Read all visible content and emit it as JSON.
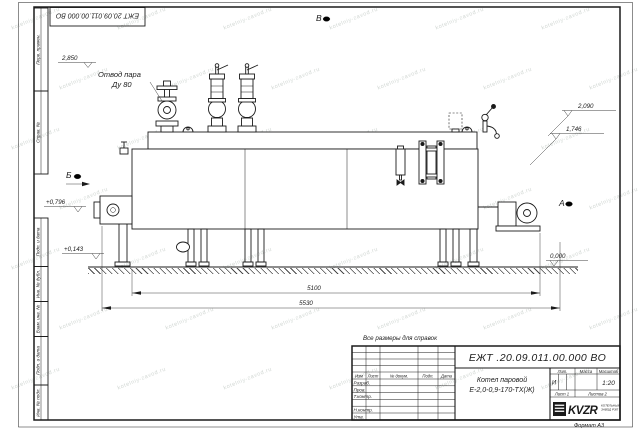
{
  "sheet": {
    "watermark": "kotelniy-zavod.ru",
    "format": "Формат А3"
  },
  "doc": {
    "number": "ЕЖТ .20.09.011.00.000  ВО",
    "number_corner": "ЕЖТ 20.09.011.00.000  ВО",
    "product_line1": "Котел паровой",
    "product_line2": "Е-2,0-0,9-170-ТХ(Ж)",
    "lit": "И",
    "scale": "1:20",
    "sheet_no": "Лист 1",
    "sheets_total": "Листов 2"
  },
  "title_block": {
    "col_izm": "Изм",
    "col_list": "Лист",
    "col_doc": "№ докум.",
    "col_sign": "Подп.",
    "col_date": "Дата",
    "row_razrab": "Разраб.",
    "row_prov": "Пров.",
    "row_tcontr": "Т.контр.",
    "row_ncontr": "Н.контр.",
    "row_utv": "Утв.",
    "hdr_lit": "Лит.",
    "hdr_mass": "Масса",
    "hdr_scale": "Масштаб",
    "logo_text": "KVZR",
    "logo_sub1": "КОТЕЛЬНЫЙ",
    "logo_sub2": "ЗАВОД РЭП"
  },
  "margin_boxes": [
    "Перв. примен.",
    "Справ. №",
    "Подп. и дата",
    "Инв. № дубл.",
    "Взам. инв. №",
    "Подп. и дата",
    "Инв. № подл."
  ],
  "annotations": {
    "note": "Все размеры для справок",
    "steam1": "Отвод пара",
    "steam2": "Ду 80",
    "view_a": "А",
    "view_b": "Б",
    "view_v": "В",
    "elev_top": "2,850",
    "elev_r1": "2,090",
    "elev_r2": "1,746",
    "elev_l1": "+0,796",
    "elev_l2": "+0,143",
    "elev_zero": "0,000",
    "dim_inner": "5100",
    "dim_overall": "5530"
  }
}
